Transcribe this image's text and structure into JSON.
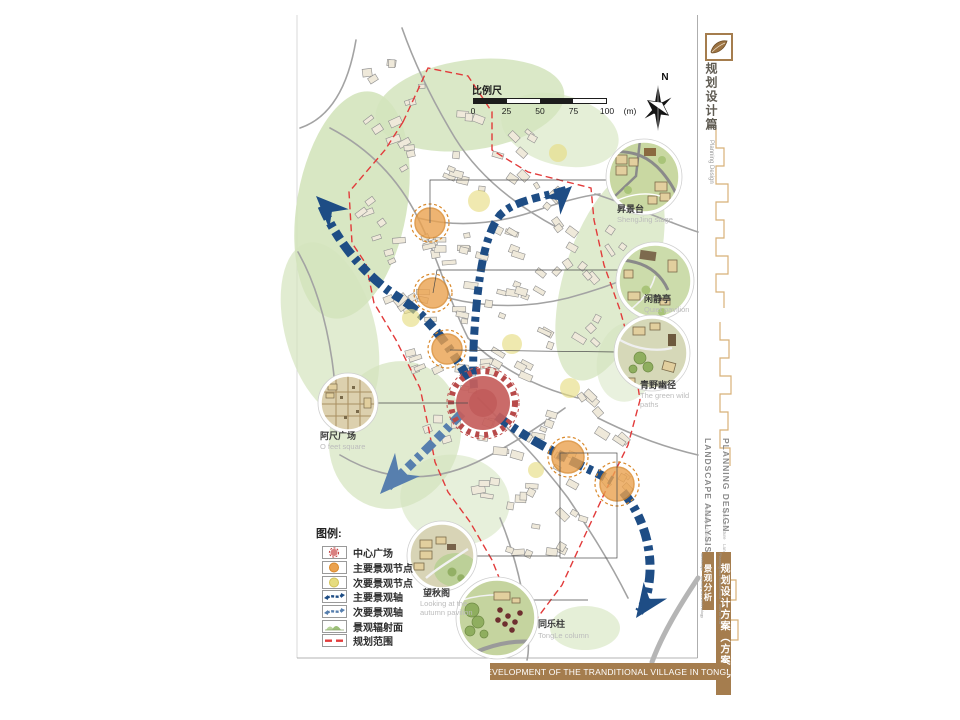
{
  "banner": {
    "text": "DEVELOPMENT OF THE TRANDITIONAL VILLAGE IN TONGLE"
  },
  "scale_bar": {
    "label": "比例尺",
    "ticks": [
      "0",
      "25",
      "50",
      "75",
      "100"
    ],
    "unit": "(m)"
  },
  "compass": {
    "label": "N"
  },
  "sidebar": {
    "section_zh": "规划设计篇",
    "section_en": "Planning Design",
    "title_en_1": "PLANNING DESIGN",
    "title_en_2": "LANDSCAPE ANALYSIS",
    "subtitle_en": [
      "Space structure",
      "Landscape node",
      "Municipal facilities"
    ],
    "plan_zh": "规划设计方案（方案A）",
    "analysis_zh": "景观分析",
    "analysis_en": [
      "Planning and architectural",
      "Interior and landscape",
      "Industry and technology"
    ]
  },
  "legend": {
    "title": "图例:",
    "items": [
      {
        "label": "中心广场"
      },
      {
        "label": "主要景观节点"
      },
      {
        "label": "次要景观节点"
      },
      {
        "label": "主要景观轴"
      },
      {
        "label": "次要景观轴"
      },
      {
        "label": "景观辐射面"
      },
      {
        "label": "规划范围"
      }
    ]
  },
  "callouts": [
    {
      "zh": "昇景台",
      "en": "ShengJing stage"
    },
    {
      "zh": "闲静亭",
      "en": "Quiet pavilion"
    },
    {
      "zh": "青野幽径",
      "en": "The green wild paths"
    },
    {
      "zh": "阿尺广场",
      "en": "O feet square"
    },
    {
      "zh": "望秋阁",
      "en": "Looking at the autumn pavilion"
    },
    {
      "zh": "同乐柱",
      "en": "TongLe column"
    }
  ],
  "colors": {
    "accent_brown": "#a57d4e",
    "axis_main": "#1e4d85",
    "axis_secondary": "#577fae",
    "node_main": "#eba24f",
    "node_secondary": "#e6dc7f",
    "plaza_red": "#c65e5c",
    "boundary_red": "#e23b3b",
    "radiation_green": "#d4e4bd"
  }
}
